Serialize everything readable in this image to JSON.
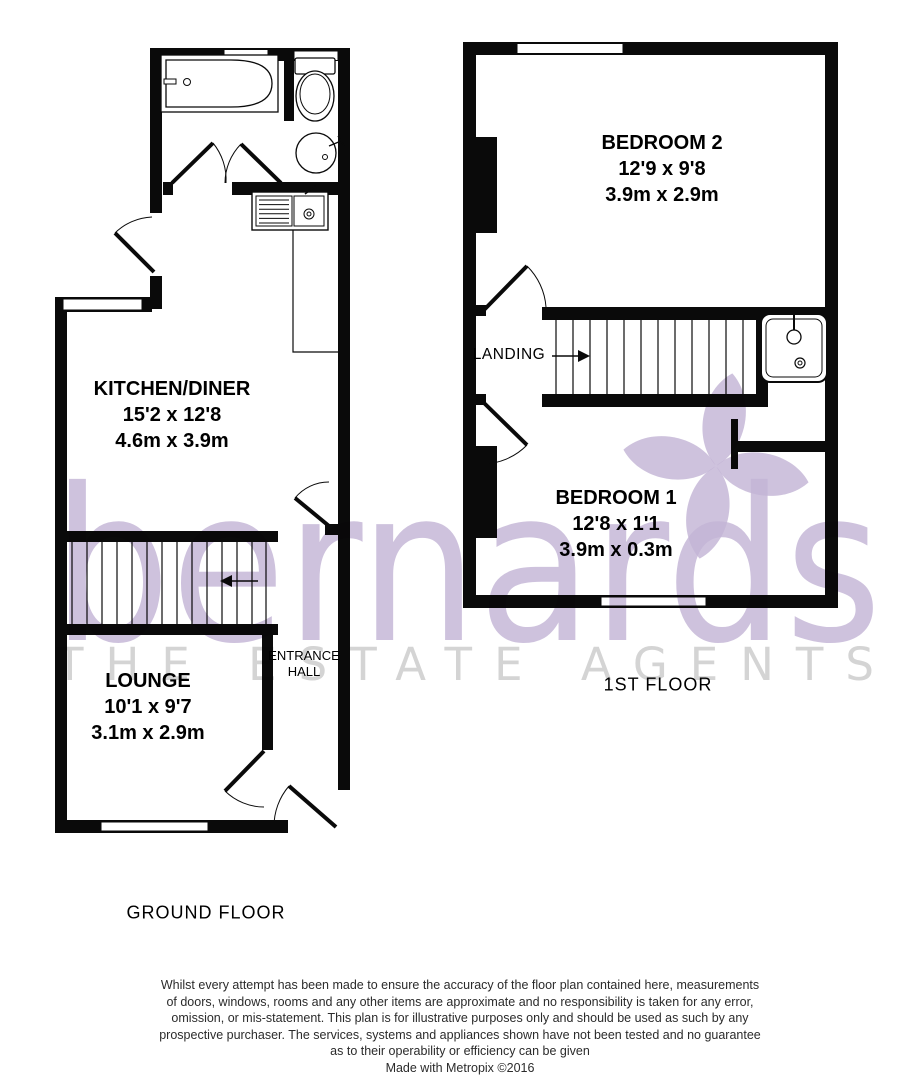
{
  "watermark": {
    "brand": "bernards",
    "tagline": "THE ESTATE AGENTS",
    "brand_color": "#c3b4d6",
    "tagline_color": "#d4d4d4"
  },
  "ground_floor": {
    "label": "GROUND FLOOR",
    "rooms": [
      {
        "name": "KITCHEN/DINER",
        "dims_ft": "15'2 x 12'8",
        "dims_m": "4.6m x 3.9m"
      },
      {
        "name": "LOUNGE",
        "dims_ft": "10'1 x 9'7",
        "dims_m": "3.1m x 2.9m"
      },
      {
        "name_line1": "ENTRANCE",
        "name_line2": "HALL"
      }
    ]
  },
  "first_floor": {
    "label": "1ST FLOOR",
    "rooms": [
      {
        "name": "BEDROOM 2",
        "dims_ft": "12'9 x 9'8",
        "dims_m": "3.9m x 2.9m"
      },
      {
        "name": "BEDROOM 1",
        "dims_ft": "12'8 x 1'1",
        "dims_m": "3.9m x 0.3m"
      },
      {
        "name": "LANDING"
      }
    ]
  },
  "disclaimer": {
    "lines": [
      "Whilst every attempt has been made to ensure the accuracy of the floor plan contained here, measurements",
      "of doors, windows, rooms and any other items are approximate and no responsibility is taken for any error,",
      "omission, or mis-statement. This plan is for illustrative purposes only and should be used as such by any",
      "prospective purchaser. The services, systems and appliances shown have not been tested and no guarantee",
      "as to their operability or efficiency can be given"
    ],
    "credit": "Made with Metropix ©2016"
  }
}
